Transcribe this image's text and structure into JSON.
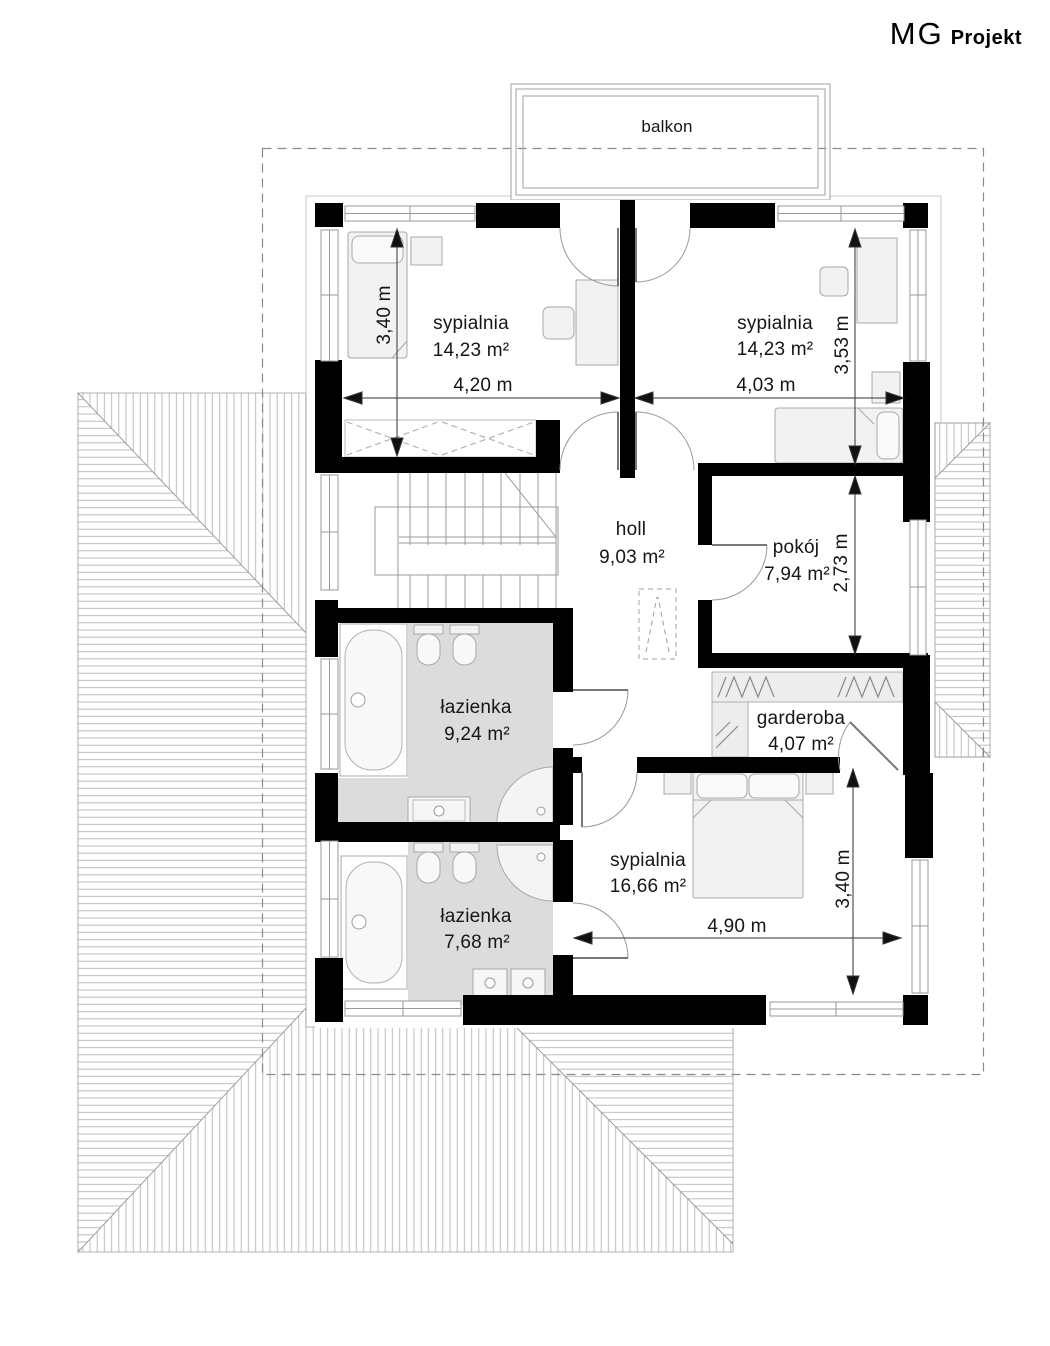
{
  "logo": {
    "mg": "MG",
    "projekt": "Projekt"
  },
  "balcony": {
    "label": "balkon"
  },
  "rooms": {
    "bedroom_top_left": {
      "name": "sypialnia",
      "area": "14,23 m²"
    },
    "bedroom_top_right": {
      "name": "sypialnia",
      "area": "14,23 m²"
    },
    "hall": {
      "name": "holl",
      "area": "9,03 m²"
    },
    "room": {
      "name": "pokój",
      "area": "7,94 m²"
    },
    "bathroom_upper": {
      "name": "łazienka",
      "area": "9,24 m²"
    },
    "wardrobe": {
      "name": "garderoba",
      "area": "4,07 m²"
    },
    "bedroom_bottom": {
      "name": "sypialnia",
      "area": "16,66 m²"
    },
    "bathroom_lower": {
      "name": "łazienka",
      "area": "7,68 m²"
    }
  },
  "dimensions": {
    "bedroom_top_left_height": "3,40 m",
    "bedroom_top_left_width": "4,20 m",
    "bedroom_top_right_width": "4,03 m",
    "bedroom_top_right_height": "3,53 m",
    "room_height": "2,73 m",
    "bedroom_bottom_height": "3,40 m",
    "bedroom_bottom_width": "4,90 m"
  },
  "colors": {
    "wall": "#000000",
    "hatch": "#b4b4b4",
    "bath_floor": "#dcdcdc",
    "furniture_fill": "#f2f2f2",
    "dashed_boundary": "#8a8a8a"
  }
}
